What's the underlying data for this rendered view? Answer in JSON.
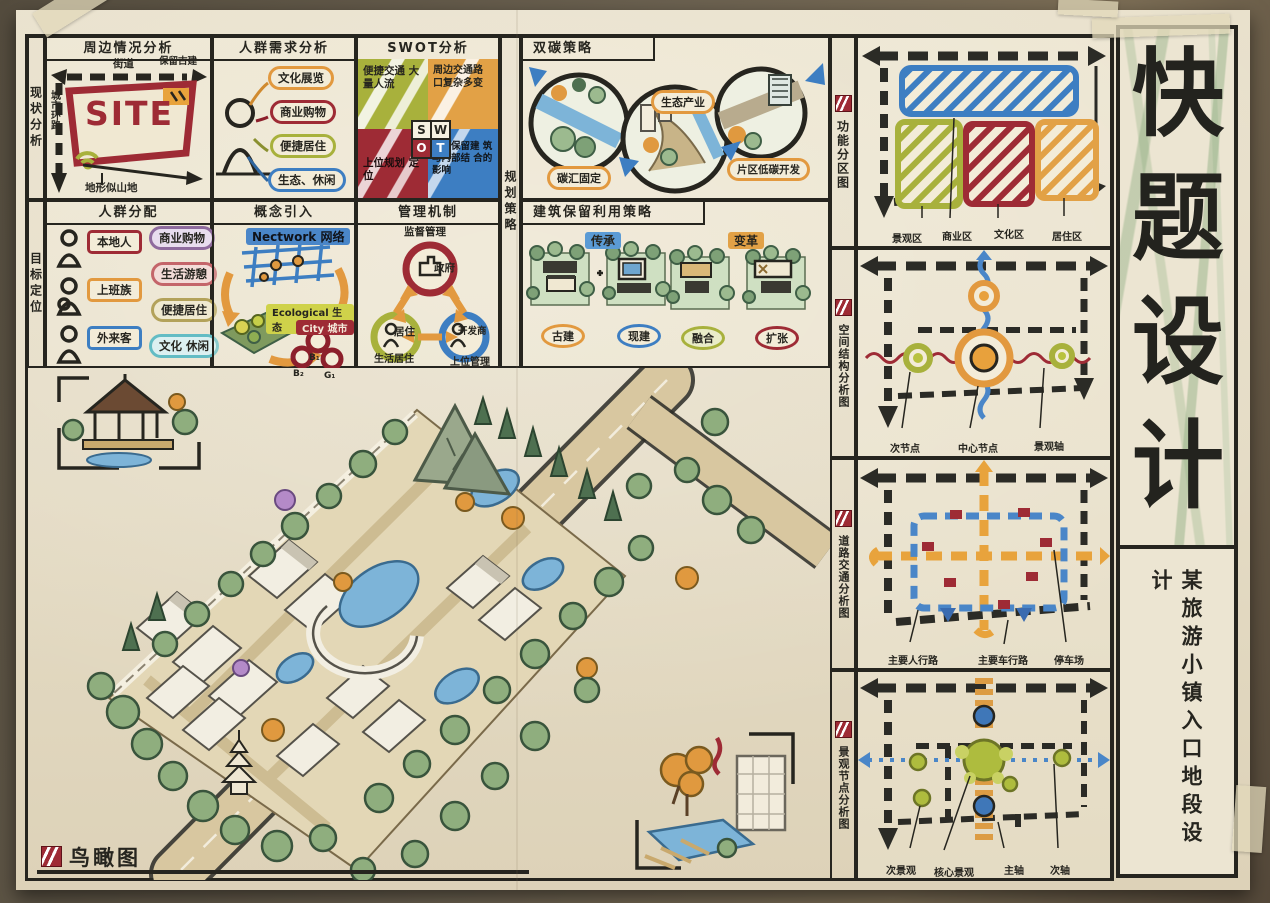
{
  "board": {
    "main_title_chars": [
      "快",
      "题",
      "设",
      "计"
    ],
    "subtitle": "某旅游小镇入口地段设计",
    "birdseye_label": "鸟瞰图",
    "colors": {
      "ink": "#26251f",
      "red": "#9e2b35",
      "orange": "#e2993f",
      "olive": "#a8b13c",
      "blue": "#3d7ec2",
      "paper": "#e7dfc9"
    }
  },
  "strips": {
    "row1": "现状分析",
    "row2": "目标定位",
    "mid": "规划策略"
  },
  "panels": {
    "site": {
      "title": "周边情况分析",
      "center": "SITE",
      "top_label": "街道",
      "topright_label": "保留古建",
      "left_label": "城市环路",
      "bottom_label": "地形似山地"
    },
    "demand": {
      "title": "人群需求分析",
      "items": [
        "文化展览",
        "商业购物",
        "便捷居住",
        "生态、休闲"
      ]
    },
    "swot": {
      "title": "SWOT分析",
      "letters": [
        "S",
        "W",
        "O",
        "T"
      ],
      "s": "便捷交通 大量人流",
      "w": "周边交通路 口复杂多变",
      "o": "上位规划 定位",
      "t": "周边保留建 筑与内部结 合的影响"
    },
    "carbon": {
      "title": "双碳策略",
      "steps": [
        "碳汇固定",
        "生态产业",
        "片区低碳开发"
      ]
    },
    "crowd": {
      "title": "人群分配",
      "groups": [
        "本地人",
        "上班族",
        "外来客"
      ],
      "needs": [
        "商业购物",
        "生活游憩",
        "便捷居住",
        "文化 休闲"
      ]
    },
    "concept": {
      "title": "概念引入",
      "network": "Nectwork 网络",
      "eco": "Ecological 生态",
      "city": "City 城市",
      "nodes": [
        "B₁",
        "B₂",
        "G₁"
      ]
    },
    "management": {
      "title": "管理机制",
      "top": "监督管理",
      "gov": "政府",
      "resident": "居住",
      "developer": "开发商",
      "resident_sub": "生活居住",
      "developer_sub": "上位管理"
    },
    "heritage": {
      "title": "建筑保留利用策略",
      "tags": [
        "传承",
        "变革"
      ],
      "stages": [
        "古建",
        "现建",
        "融合",
        "扩张"
      ]
    }
  },
  "right_panels": [
    {
      "label": "功能分区图",
      "legend": [
        "景观区",
        "商业区",
        "文化区",
        "居住区"
      ]
    },
    {
      "label": "空间结构分析图",
      "legend": [
        "次节点",
        "中心节点",
        "景观轴"
      ]
    },
    {
      "label": "道路交通分析图",
      "legend": [
        "主要人行路",
        "主要车行路",
        "停车场"
      ]
    },
    {
      "label": "景观节点分析图",
      "legend": [
        "次景观",
        "核心景观",
        "主轴",
        "次轴"
      ]
    }
  ]
}
